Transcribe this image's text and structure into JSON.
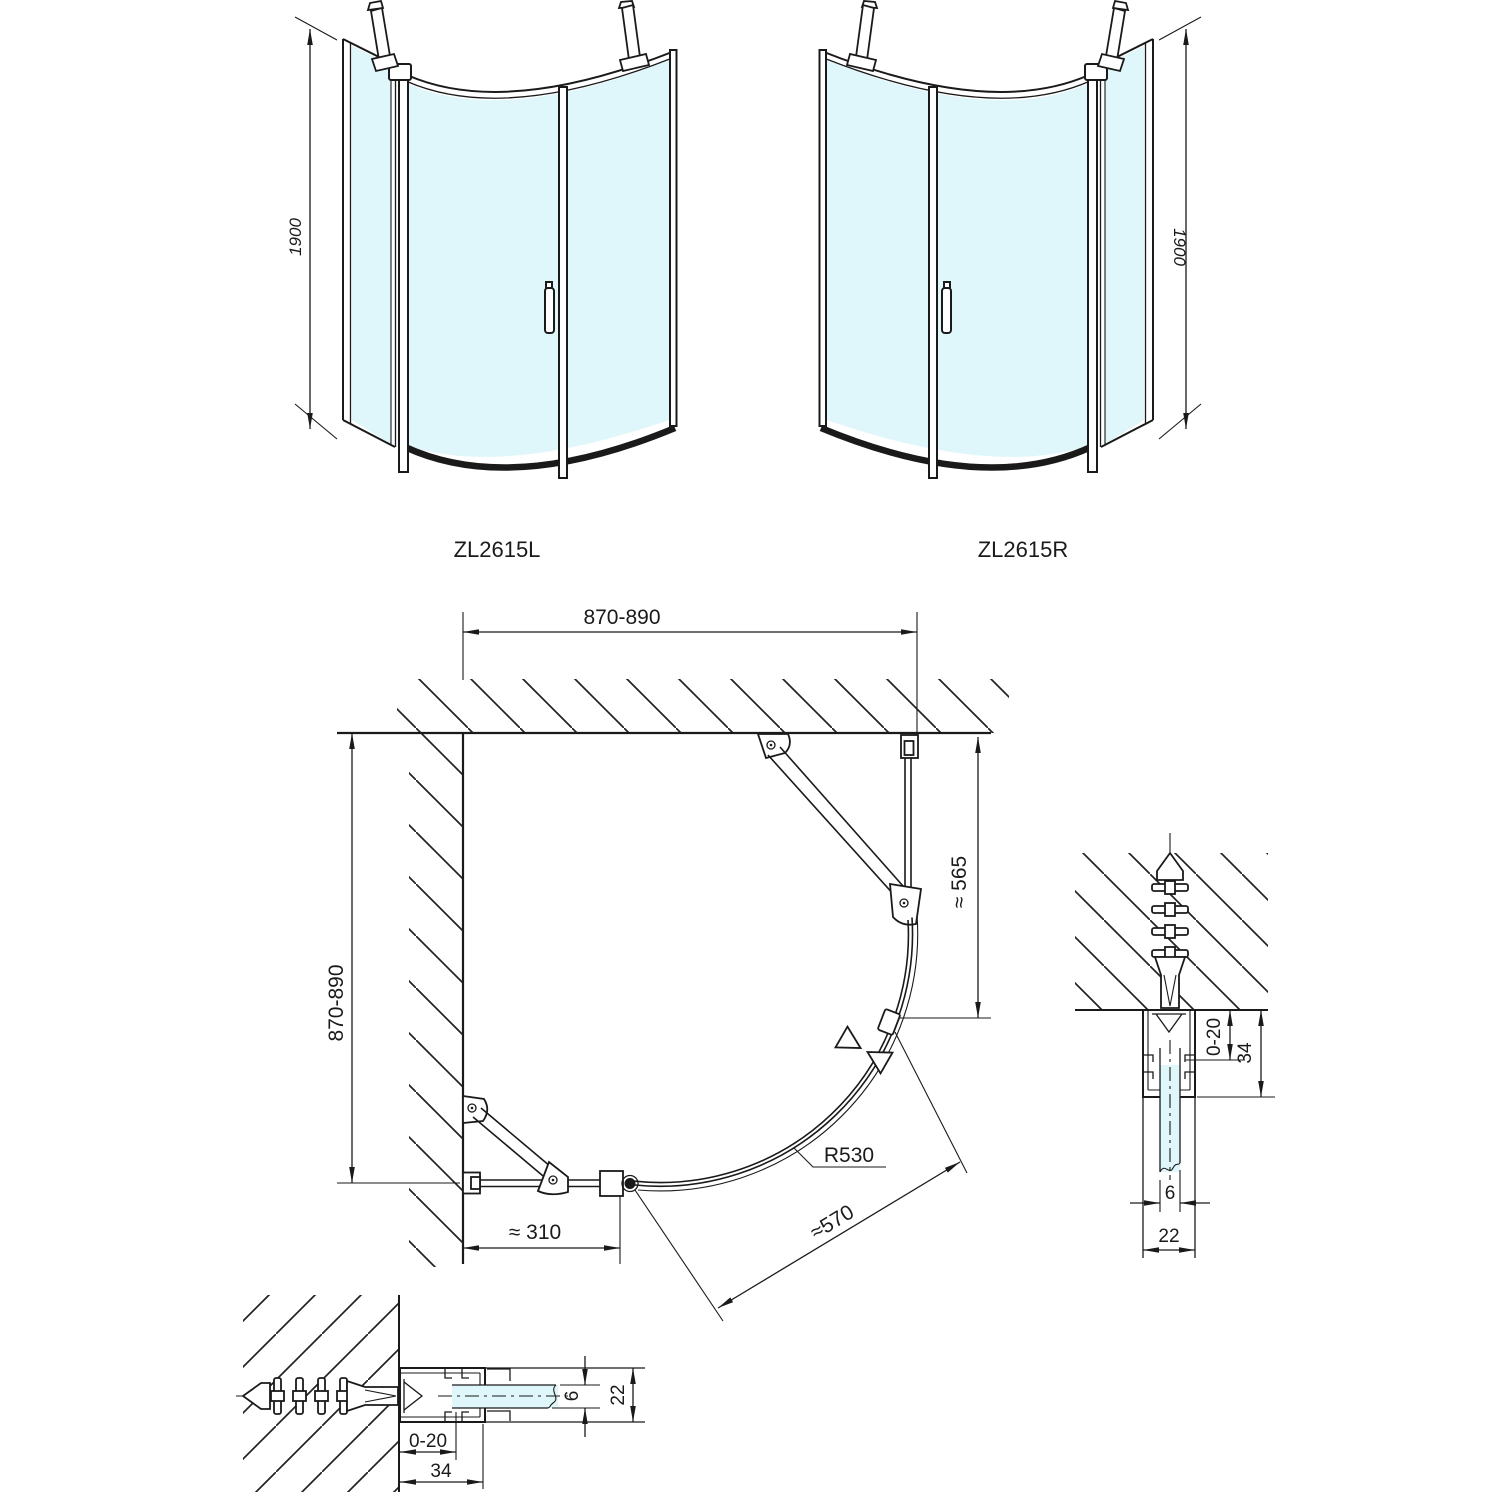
{
  "colors": {
    "line": "#1a1a1a",
    "glass": "#dff7fa",
    "background": "#ffffff"
  },
  "front_views": {
    "left": {
      "label": "ZL2615L",
      "height_dim": "1900"
    },
    "right": {
      "label": "ZL2615R",
      "height_dim": "1900"
    }
  },
  "plan_view": {
    "width_dim": "870-890",
    "depth_dim": "870-890",
    "side_fixed_dim": "≈ 565",
    "back_fixed_dim": "≈ 310",
    "entry_dim": "≈570",
    "radius_dim": "R530"
  },
  "section_details": {
    "right": {
      "adjust_dim": "0-20",
      "profile_depth_dim": "34",
      "glass_thickness_dim": "6",
      "profile_width_dim": "22"
    },
    "bottom": {
      "adjust_dim": "0-20",
      "profile_depth_dim": "34",
      "glass_thickness_dim": "6",
      "profile_width_dim": "22"
    }
  }
}
